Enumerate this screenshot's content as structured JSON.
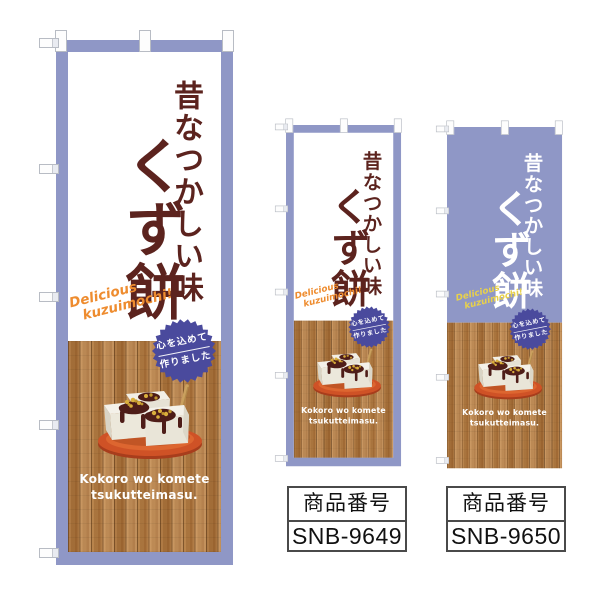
{
  "banner": {
    "title_sub": "昔なつかしい味",
    "title_main": "くず餅",
    "script_line1": "Delicious",
    "script_line2": "kuzuimochi!",
    "badge_line1": "心を込めて",
    "badge_line2": "作りました",
    "romaji_line1": "Kokoro wo komete",
    "romaji_line2": "tsukutteimasu."
  },
  "products": [
    {
      "label": "商品番号",
      "code": "SNB-9649"
    },
    {
      "label": "商品番号",
      "code": "SNB-9650"
    }
  ],
  "colors": {
    "purple": "#8F97C6",
    "badge_purple": "#4A4A9D",
    "title_maroon": "#5C231E",
    "script_orange": "#EE8C2F",
    "script_yellow": "#E8D14B",
    "wood_brown": "#B27C43",
    "plate_orange": "#CF5226"
  }
}
